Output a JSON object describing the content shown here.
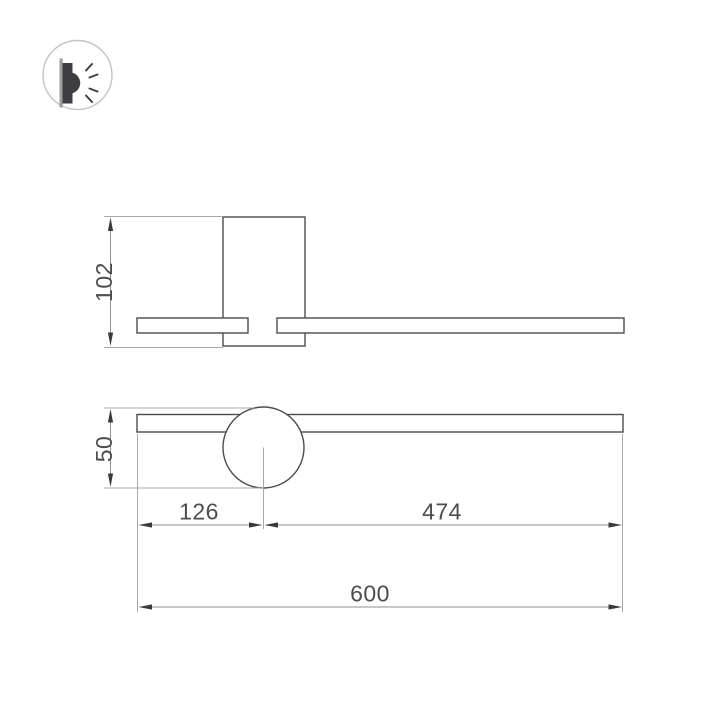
{
  "drawing": {
    "type": "wall-lamp-dimension-drawing",
    "icon": {
      "name": "wall-lamp-side-glow-icon"
    },
    "dimensions": {
      "top_view_depth": "102",
      "front_height": "50",
      "left_offset": "126",
      "right_offset": "474",
      "overall_length": "600"
    }
  },
  "colors": {
    "background": "#ffffff",
    "object_line": "#4a4b4d",
    "extension_line": "#a8a8a8",
    "dimension_line": "#8f8f8f",
    "arrow": "#3a3a3c",
    "label_text": "#4d4d4f",
    "icon_body": "#3e3e40",
    "icon_ring": "#c4c4c4",
    "icon_plate": "#9e9e9e"
  }
}
